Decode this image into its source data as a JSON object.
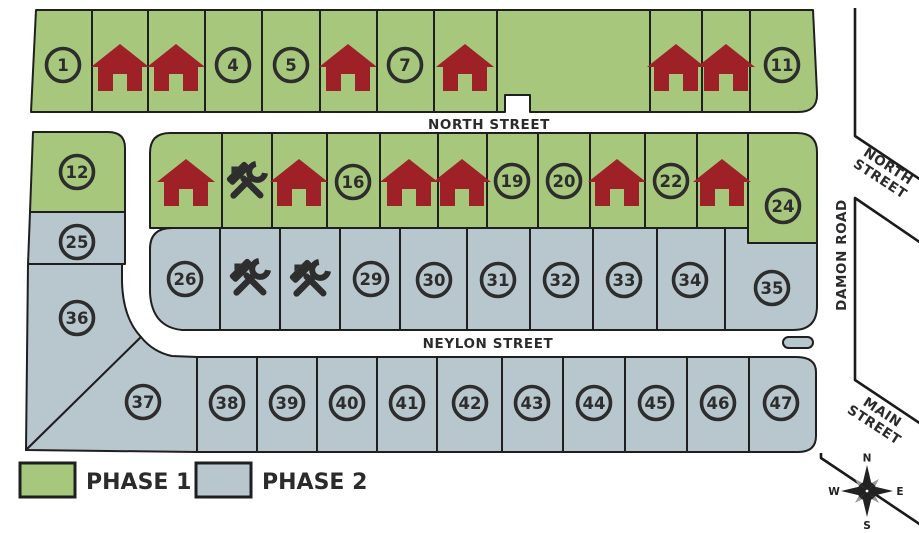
{
  "map_title": "residential-lot-site-plan",
  "legend": {
    "phase1_label": "PHASE 1",
    "phase2_label": "PHASE 2",
    "phase1_color": "#a7c77d",
    "phase2_color": "#b8c6ce"
  },
  "streets": {
    "north_top": "NORTH STREET",
    "neylon": "NEYLON STREET",
    "damon": "DAMON ROAD",
    "north_right_line1": "NORTH",
    "north_right_line2": "STREET",
    "main_line1": "MAIN",
    "main_line2": "STREET"
  },
  "compass": {
    "n": "N",
    "s": "S",
    "e": "E",
    "w": "W"
  },
  "markers": {
    "sold_color": "#9e2127",
    "construction_color": "#2e2e2e",
    "circle_color": "#2d2d2d"
  },
  "lots": [
    {
      "num": "1",
      "status": "available",
      "phase": 1
    },
    {
      "num": "2",
      "status": "sold",
      "phase": 1
    },
    {
      "num": "3",
      "status": "sold",
      "phase": 1
    },
    {
      "num": "4",
      "status": "available",
      "phase": 1
    },
    {
      "num": "5",
      "status": "available",
      "phase": 1
    },
    {
      "num": "6",
      "status": "sold",
      "phase": 1
    },
    {
      "num": "7",
      "status": "available",
      "phase": 1
    },
    {
      "num": "8",
      "status": "sold",
      "phase": 1
    },
    {
      "num": "9",
      "status": "sold",
      "phase": 1
    },
    {
      "num": "10",
      "status": "sold",
      "phase": 1
    },
    {
      "num": "11",
      "status": "available",
      "phase": 1
    },
    {
      "num": "12",
      "status": "available",
      "phase": 1
    },
    {
      "num": "13",
      "status": "sold",
      "phase": 1
    },
    {
      "num": "14",
      "status": "construction",
      "phase": 1
    },
    {
      "num": "15",
      "status": "sold",
      "phase": 1
    },
    {
      "num": "16",
      "status": "available",
      "phase": 1
    },
    {
      "num": "17",
      "status": "sold",
      "phase": 1
    },
    {
      "num": "18",
      "status": "sold",
      "phase": 1
    },
    {
      "num": "19",
      "status": "available",
      "phase": 1
    },
    {
      "num": "20",
      "status": "available",
      "phase": 1
    },
    {
      "num": "21",
      "status": "sold",
      "phase": 1
    },
    {
      "num": "22",
      "status": "available",
      "phase": 1
    },
    {
      "num": "23",
      "status": "sold",
      "phase": 1
    },
    {
      "num": "24",
      "status": "available",
      "phase": 1
    },
    {
      "num": "25",
      "status": "available",
      "phase": 2
    },
    {
      "num": "26",
      "status": "available",
      "phase": 2
    },
    {
      "num": "27",
      "status": "construction",
      "phase": 2
    },
    {
      "num": "28",
      "status": "construction",
      "phase": 2
    },
    {
      "num": "29",
      "status": "available",
      "phase": 2
    },
    {
      "num": "30",
      "status": "available",
      "phase": 2
    },
    {
      "num": "31",
      "status": "available",
      "phase": 2
    },
    {
      "num": "32",
      "status": "available",
      "phase": 2
    },
    {
      "num": "33",
      "status": "available",
      "phase": 2
    },
    {
      "num": "34",
      "status": "available",
      "phase": 2
    },
    {
      "num": "35",
      "status": "available",
      "phase": 2
    },
    {
      "num": "36",
      "status": "available",
      "phase": 2
    },
    {
      "num": "37",
      "status": "available",
      "phase": 2
    },
    {
      "num": "38",
      "status": "available",
      "phase": 2
    },
    {
      "num": "39",
      "status": "available",
      "phase": 2
    },
    {
      "num": "40",
      "status": "available",
      "phase": 2
    },
    {
      "num": "41",
      "status": "available",
      "phase": 2
    },
    {
      "num": "42",
      "status": "available",
      "phase": 2
    },
    {
      "num": "43",
      "status": "available",
      "phase": 2
    },
    {
      "num": "44",
      "status": "available",
      "phase": 2
    },
    {
      "num": "45",
      "status": "available",
      "phase": 2
    },
    {
      "num": "46",
      "status": "available",
      "phase": 2
    },
    {
      "num": "47",
      "status": "available",
      "phase": 2
    }
  ]
}
